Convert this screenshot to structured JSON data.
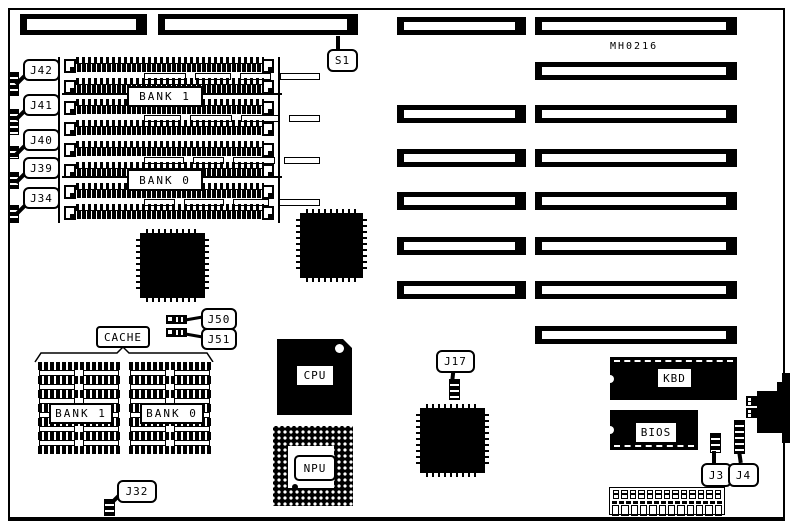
{
  "board": {
    "part_number": "MH0216"
  },
  "callouts": {
    "s1": "S1",
    "j42": "J42",
    "j41": "J41",
    "j40": "J40",
    "j39": "J39",
    "j34": "J34",
    "j50": "J50",
    "j51": "J51",
    "j32": "J32",
    "j17": "J17",
    "j3": "J3",
    "j4": "J4"
  },
  "memory": {
    "bank1_label": "BANK 1",
    "bank0_label": "BANK 0"
  },
  "cache": {
    "label": "CACHE",
    "bank1_label": "BANK 1",
    "bank0_label": "BANK 0"
  },
  "chips": {
    "cpu_label": "CPU",
    "npu_label": "NPU",
    "kbd_label": "KBD",
    "bios_label": "BIOS"
  },
  "colors": {
    "ink": "#000000",
    "paper": "#ffffff"
  }
}
